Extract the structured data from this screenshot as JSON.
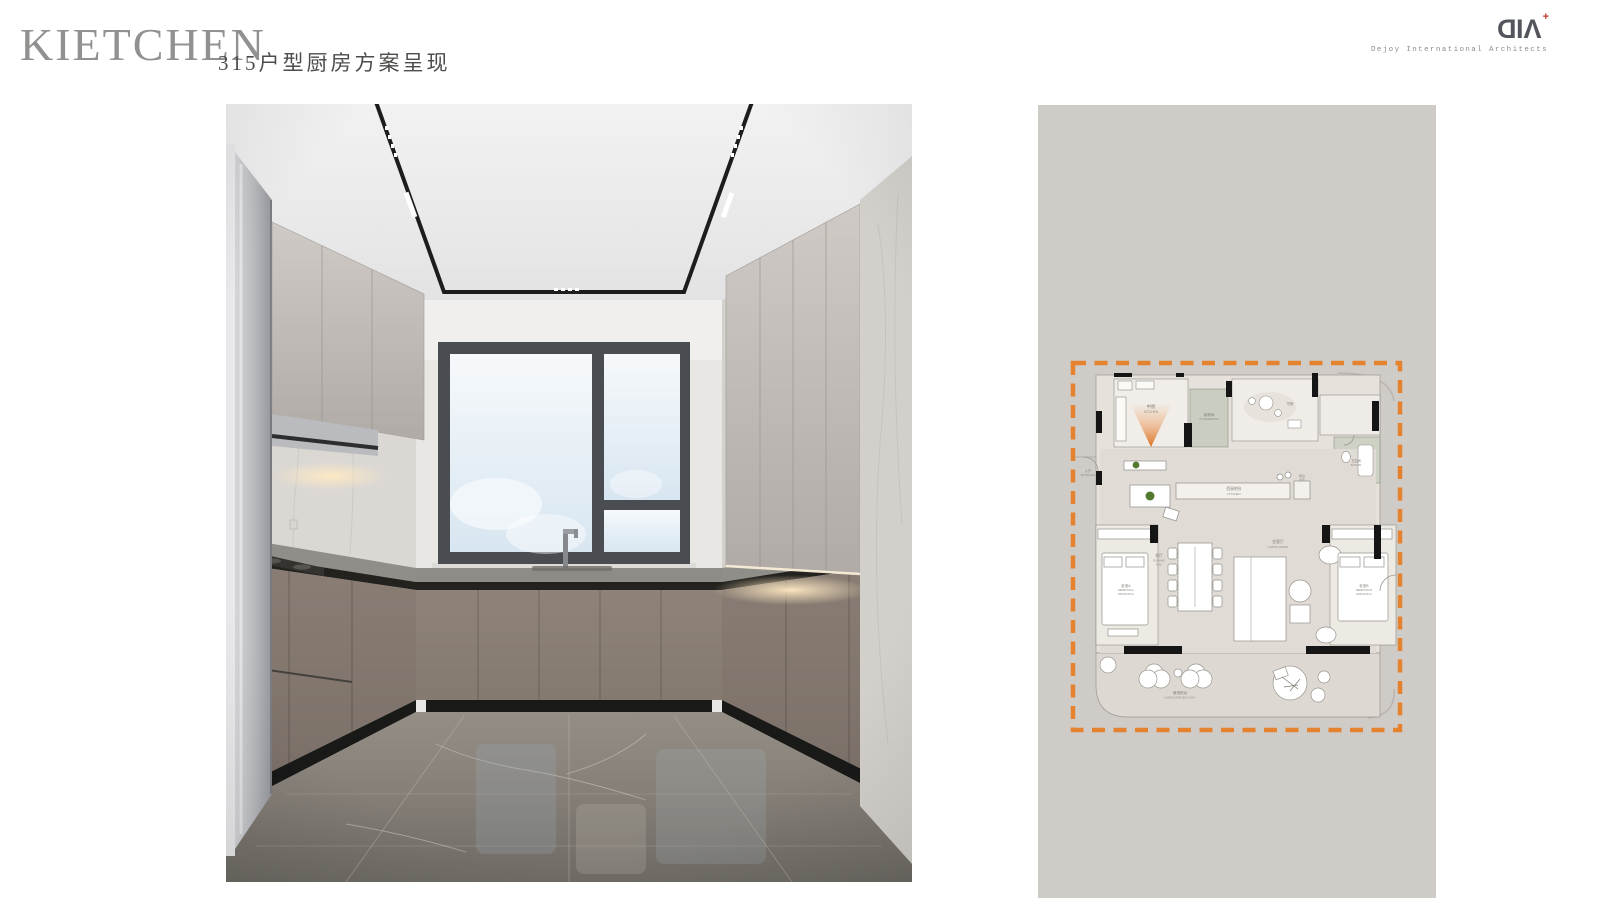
{
  "header": {
    "title": "KIETCHEN",
    "subtitle": "315户型厨房方案呈现"
  },
  "logo": {
    "mark_d": "D",
    "mark_i": "I",
    "mark_a": "Λ",
    "mark_plus": "+",
    "caption": "Dejoy International Architects"
  },
  "plan": {
    "kitchen_zh": "中厨",
    "kitchen_en": "KITCHEN",
    "housekeeping_zh": "家政间",
    "housekeeping_en": "HOUSEKEEPING",
    "study_zh": "书房",
    "bath_zh": "卫生间",
    "bath_en": "BATH RM",
    "island_zh": "西厨吧台",
    "island_en": "KITCHEN",
    "bar_zh": "吧台",
    "bar_en": "BAR",
    "entrance_zh": "入户",
    "entrance_en": "ENTRANCE",
    "dining_zh": "餐厅",
    "dining_en1": "DINNING",
    "dining_en2": "R.M.",
    "living_zh": "会客厅",
    "living_en": "LIVING ROOM",
    "bedroom_a_zh": "卧室A",
    "bedroom_a_en": "BEDROOM A",
    "bedroom_a_size": "1800X2100mm",
    "bedroom_b_zh": "卧室B",
    "bedroom_b_en": "BEDROOM B",
    "bedroom_b_size": "1800X2100mm",
    "balcony_zh": "景观阳台",
    "balcony_en": "LANDSCAPE  BALCONY"
  },
  "colors": {
    "accent_orange": "#E5822F",
    "panel_bg": "#CFCCC8",
    "title_gray": "#91918F",
    "logo_red": "#C2362B"
  }
}
